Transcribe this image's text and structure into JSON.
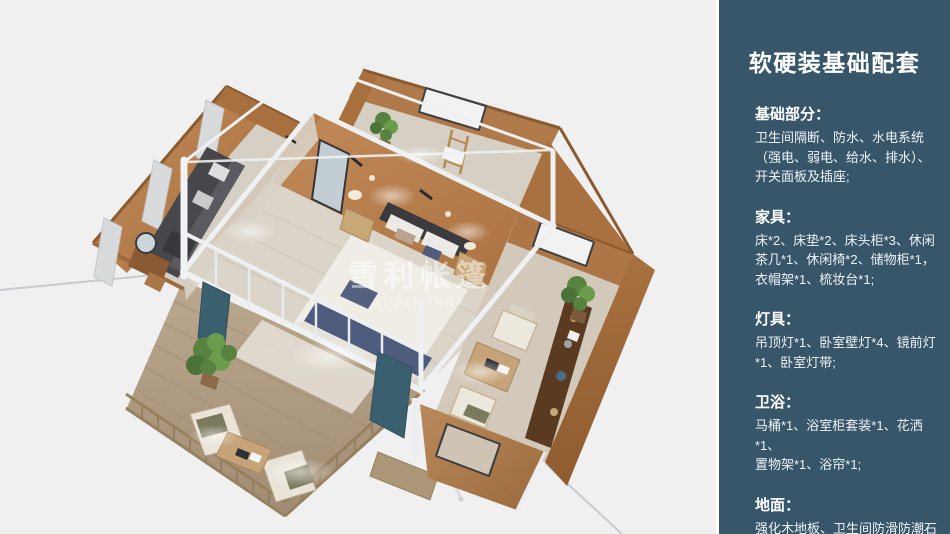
{
  "colors": {
    "panel_bg": "#375669",
    "scene_bg": "#f0f0f1",
    "wall_tan": "#b0794a",
    "curtain_teal": "#3a5f6e"
  },
  "panel": {
    "title": "软硬装基础配套",
    "sections": [
      {
        "heading": "基础部分：",
        "body": "卫生间隔断、防水、水电系统\n（强电、弱电、给水、排水）、\n开关面板及插座;"
      },
      {
        "heading": "家具：",
        "body": "床*2、床垫*2、床头柜*3、休闲\n茶几*1、休闲椅*2、储物柜*1，\n衣帽架*1、梳妆台*1;"
      },
      {
        "heading": "灯具：",
        "body": "吊顶灯*1、卧室壁灯*4、镜前灯\n*1、卧室灯带;"
      },
      {
        "heading": "卫浴：",
        "body": "马桶*1、浴室柜套装*1、花洒*1、\n置物架*1、浴帘*1;"
      },
      {
        "heading": "地面：",
        "body": "强化木地板、卫生间防滑防潮石\n塑板;"
      }
    ]
  },
  "illustration": {
    "watermark_cn": "雪利帐篷",
    "watermark_en": "XUELI TENT"
  }
}
